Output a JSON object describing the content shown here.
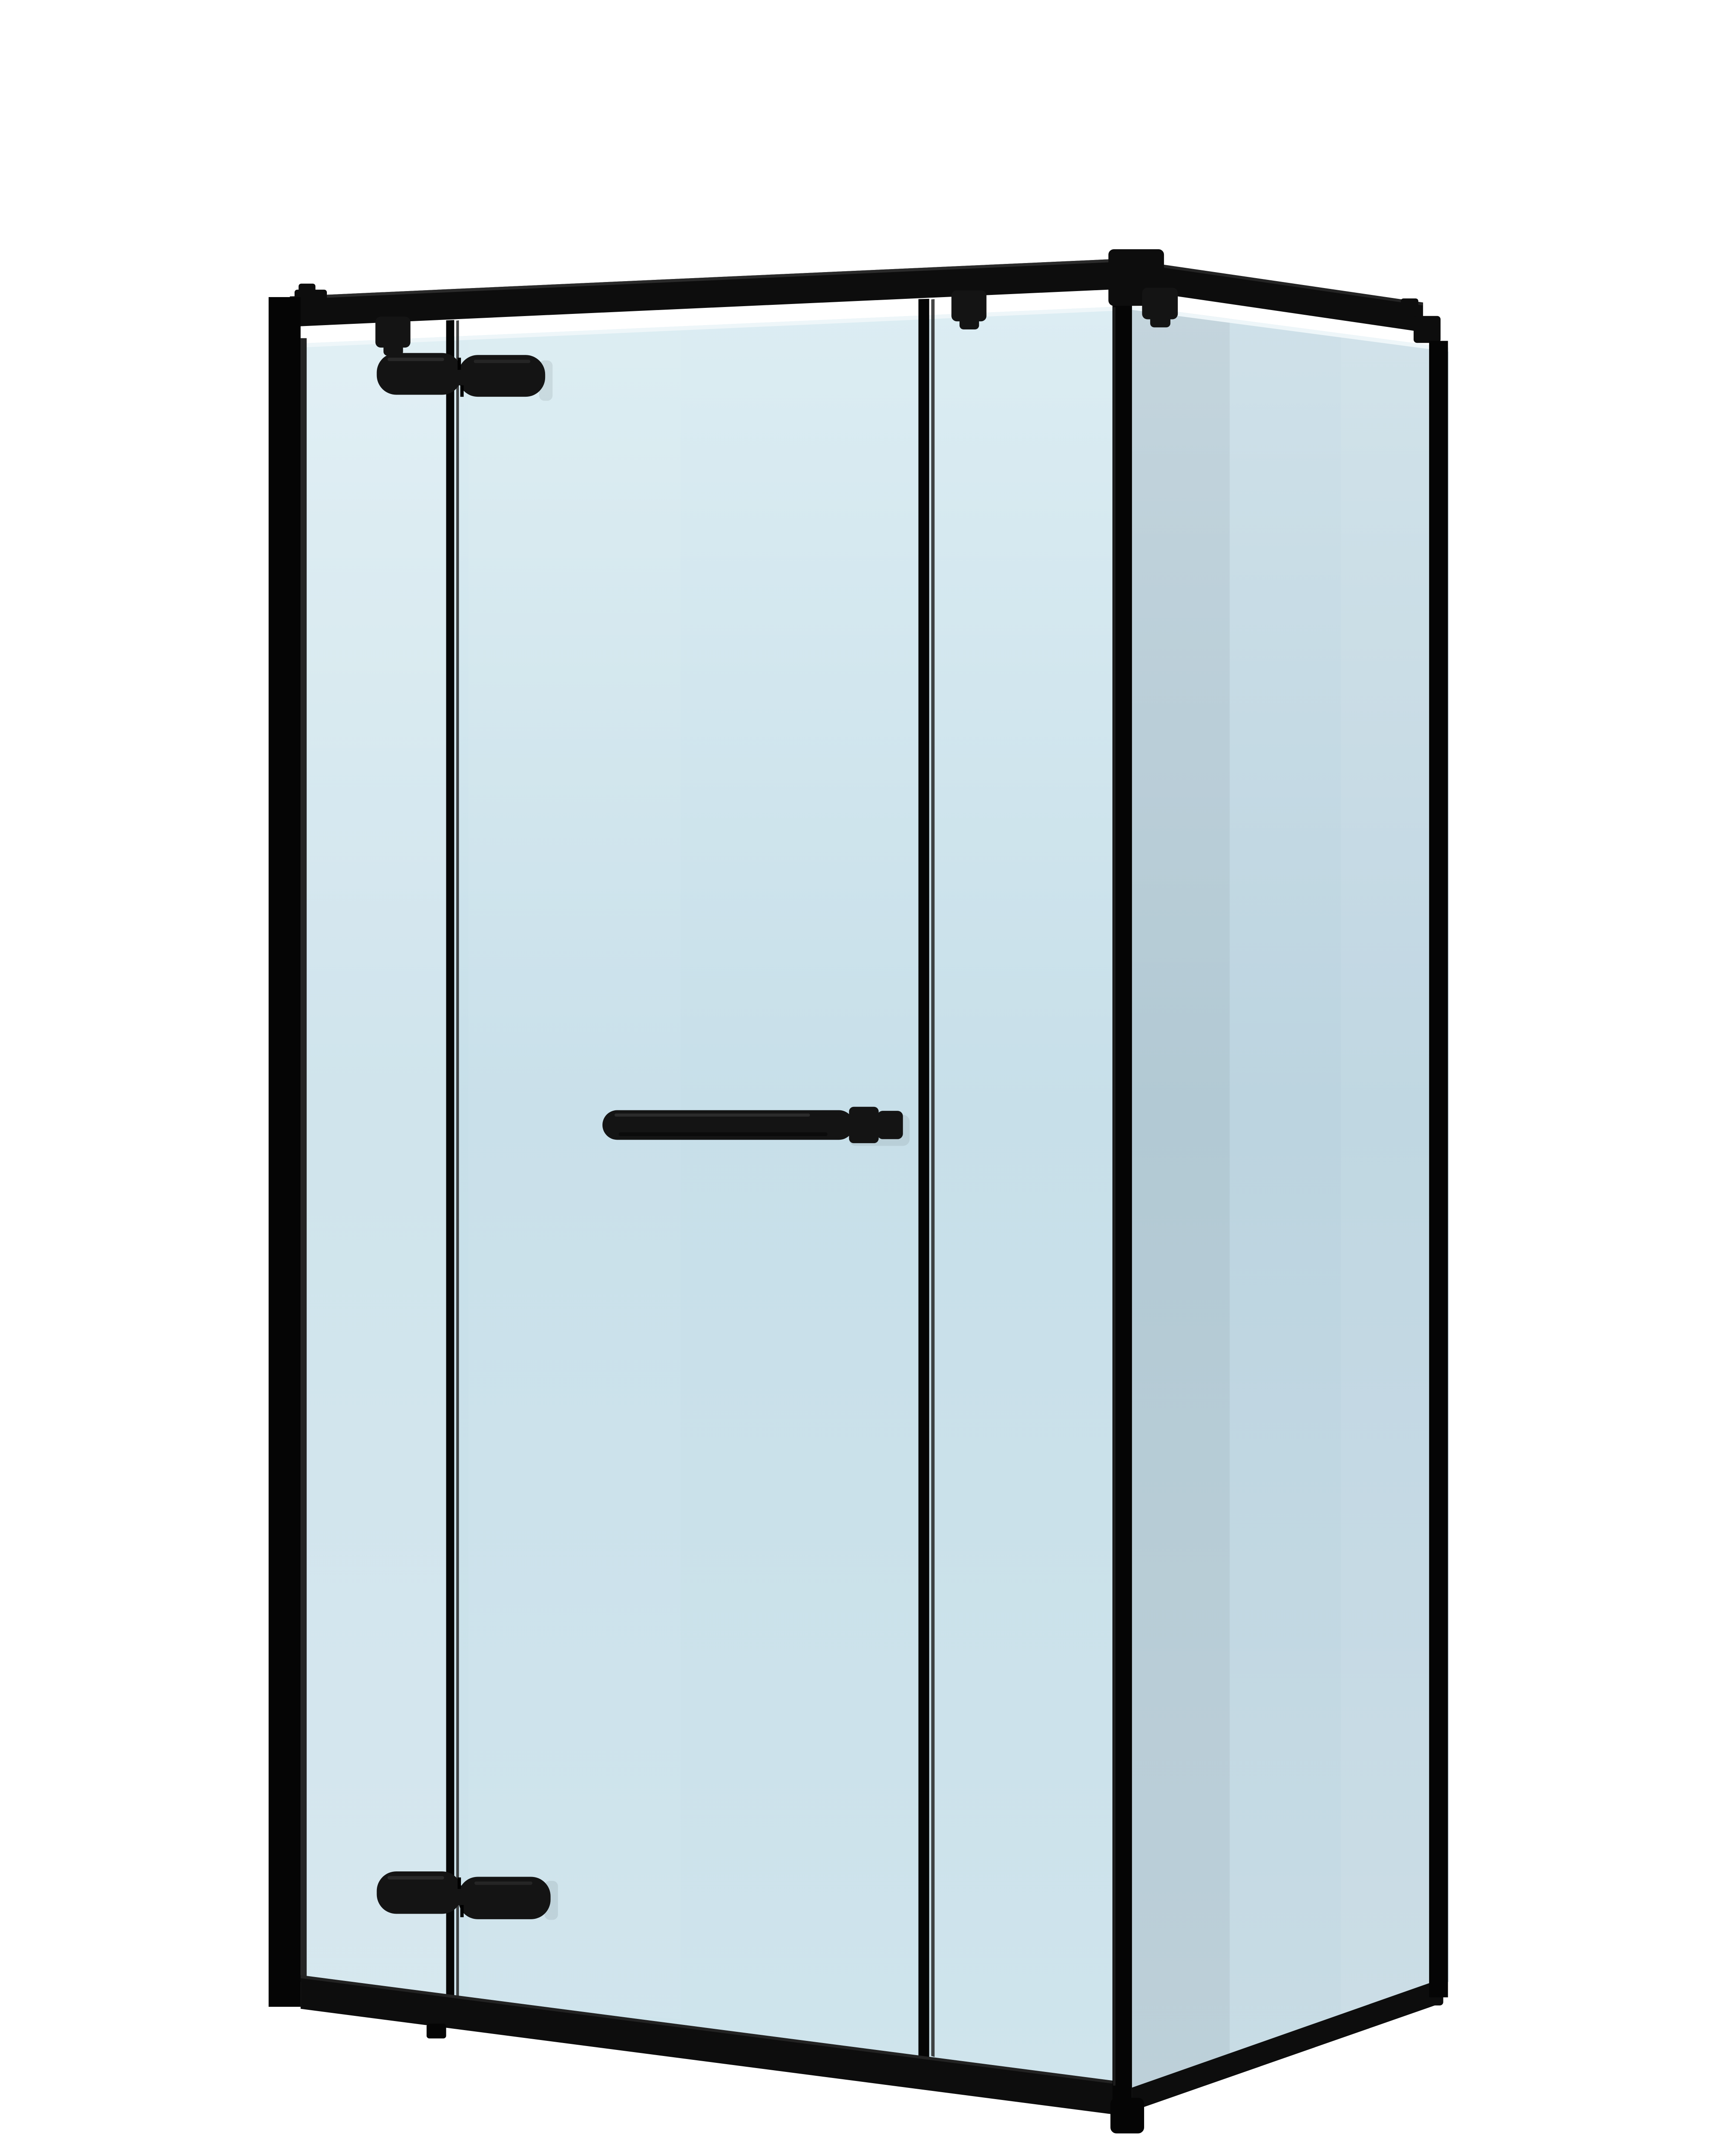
{
  "page": {
    "title": "Corner shower enclosure with matte black frame and tinted glass — 3D product render on white background"
  },
  "colors": {
    "background": "#ffffff",
    "frame": "#0d0d0d",
    "frame_deep": "#050505",
    "frame_inner": "#242424",
    "frame_highlight": "#343434",
    "hardware": "#141414",
    "hardware_sheen": "#3a3a3a",
    "glass_front_top": "#dcedf3",
    "glass_front_mid": "#c7dfe9",
    "glass_front_low": "#cfe4ec",
    "glass_side_top": "#cfe1e9",
    "glass_side_mid": "#bcd4e0",
    "glass_side_low": "#c8dce5",
    "glass_edge": "#eef6f9"
  },
  "parts": {
    "enclosure": {
      "label": "Black framed corner shower enclosure render"
    },
    "wall_profile": {
      "label": "Left wall mounting profile"
    },
    "front_top_rail": {
      "label": "Front top support rail"
    },
    "side_top_rail": {
      "label": "Side top support rail"
    },
    "front_bottom_rail": {
      "label": "Front bottom frame rail"
    },
    "side_bottom_rail": {
      "label": "Side bottom frame rail"
    },
    "corner_post": {
      "label": "Corner post profile"
    },
    "rear_wall_profile": {
      "label": "Rear wall profile of side panel"
    },
    "fixed_panel_left": {
      "label": "Fixed glass panel, hinge side"
    },
    "door": {
      "label": "Hinged glass door"
    },
    "fixed_panel_right": {
      "label": "Fixed glass panel, handle side"
    },
    "side_panel": {
      "label": "Side return glass panel"
    },
    "handle": {
      "label": "Horizontal door handle"
    },
    "hinge_upper": {
      "label": "Upper pivot hinge"
    },
    "hinge_lower": {
      "label": "Lower pivot hinge"
    },
    "clamp_left": {
      "label": "Top glass clamp, fixed panel"
    },
    "clamp_right": {
      "label": "Top glass clamp, handle-side panel"
    },
    "clamp_side": {
      "label": "Top glass clamp, side panel"
    },
    "bracket_top_left": {
      "label": "Top rail wall bracket, left"
    },
    "bracket_top_rear": {
      "label": "Top rail wall bracket, rear"
    }
  }
}
